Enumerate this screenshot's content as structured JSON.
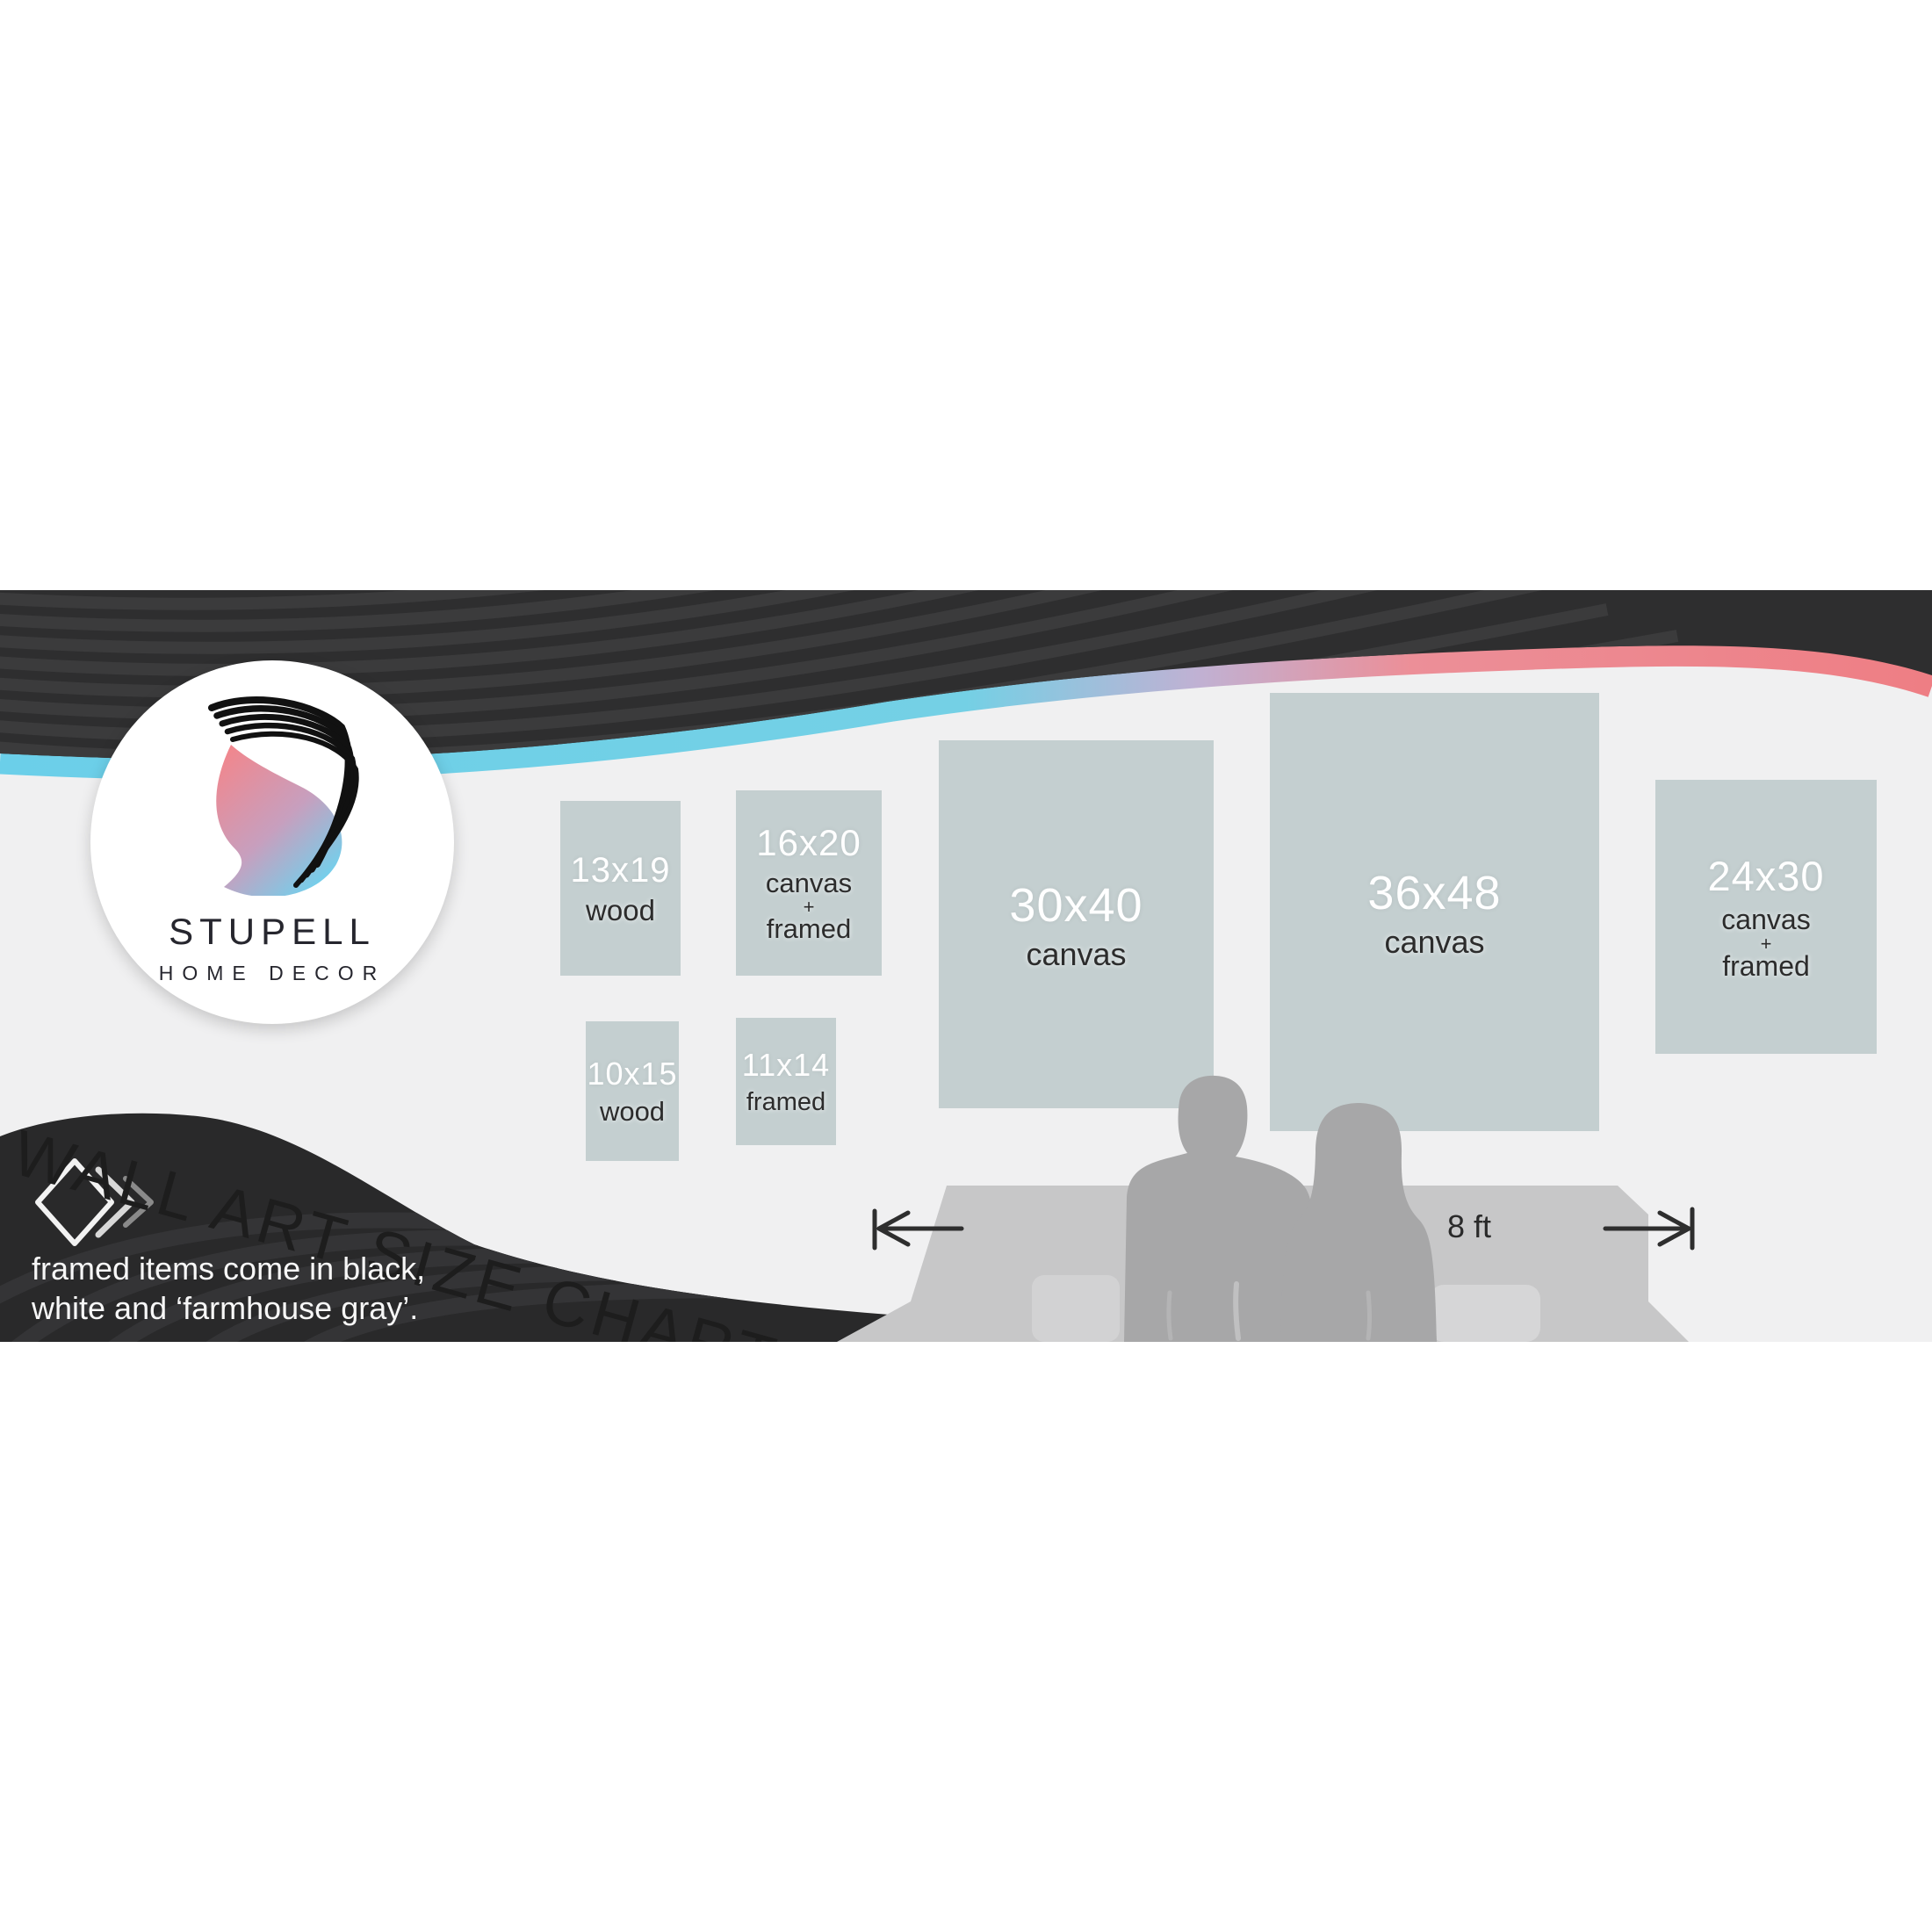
{
  "brand": {
    "name": "STUPELL",
    "tagline": "HOME DECOR"
  },
  "title": {
    "text": "WALL ART SIZE CHART"
  },
  "note": {
    "line1": "framed items come in black,",
    "line2": "white and ‘farmhouse gray’."
  },
  "measure": {
    "label": "8 ft"
  },
  "size_boxes": {
    "b13x19": {
      "size": "13x19",
      "type": [
        "wood"
      ]
    },
    "b16x20": {
      "size": "16x20",
      "type": [
        "canvas",
        "+",
        "framed"
      ]
    },
    "b10x15": {
      "size": "10x15",
      "type": [
        "wood"
      ]
    },
    "b11x14": {
      "size": "11x14",
      "type": [
        "framed"
      ]
    },
    "b30x40": {
      "size": "30x40",
      "type": [
        "canvas"
      ]
    },
    "b36x48": {
      "size": "36x48",
      "type": [
        "canvas"
      ]
    },
    "b24x30": {
      "size": "24x30",
      "type": [
        "canvas",
        "+",
        "framed"
      ]
    }
  },
  "colors": {
    "wall": "#f0f0f1",
    "box_fill": "#c4cfd0",
    "band_dark": "#2e2e2f",
    "swoosh_dark": "#29292a",
    "accent_cyan": "#6bcfe9",
    "accent_lavender": "#c0b1d3",
    "accent_pink": "#ee7e84",
    "couch_gray": "#c7c7c8",
    "people_gray": "#a7a7a8"
  }
}
